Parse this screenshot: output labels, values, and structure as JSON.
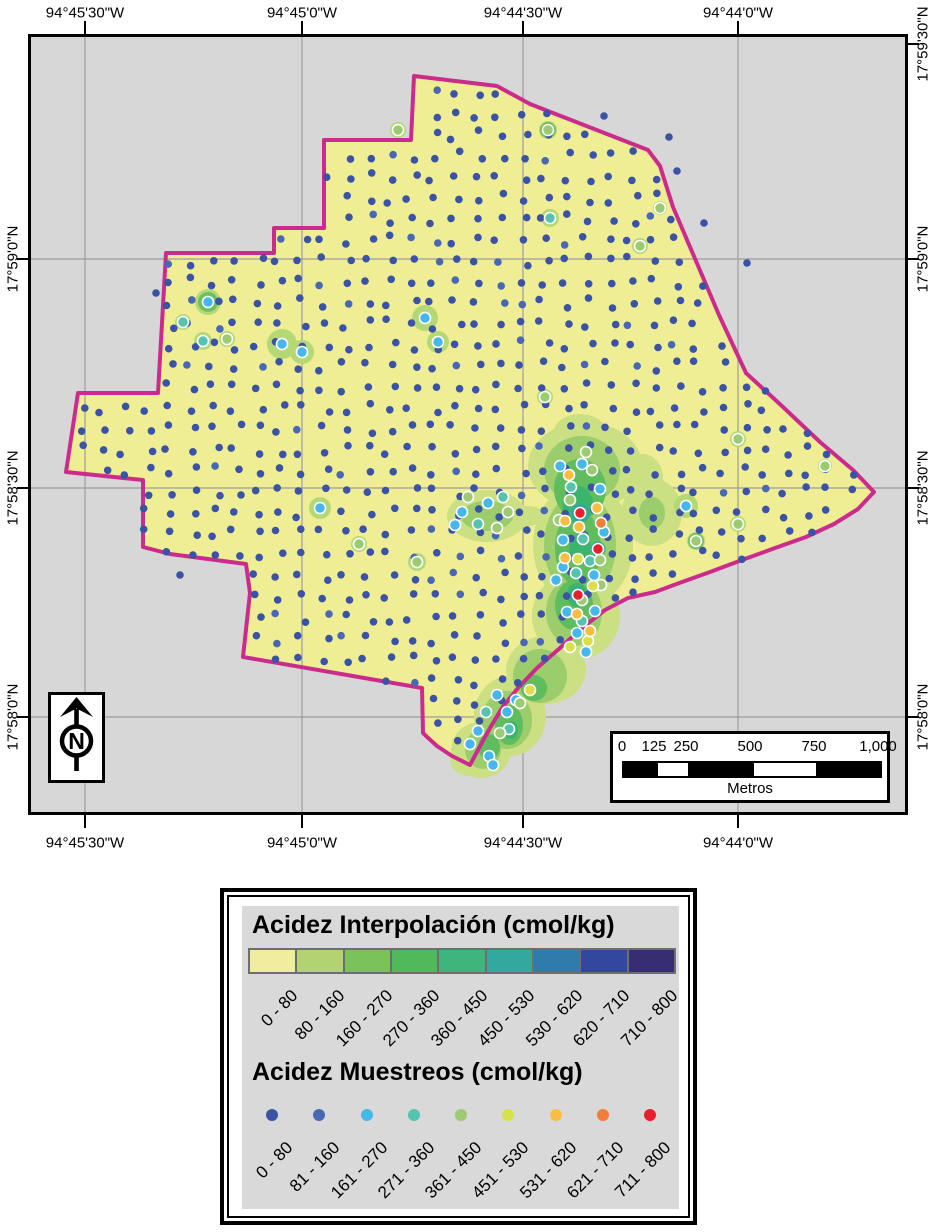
{
  "axes": {
    "top": [
      {
        "label": "94°45'30\"W",
        "x": 85
      },
      {
        "label": "94°45'0\"W",
        "x": 302
      },
      {
        "label": "94°44'30\"W",
        "x": 523
      },
      {
        "label": "94°44'0\"W",
        "x": 738
      }
    ],
    "bottom": [
      {
        "label": "94°45'30\"W",
        "x": 85
      },
      {
        "label": "94°45'0\"W",
        "x": 302
      },
      {
        "label": "94°44'30\"W",
        "x": 523
      },
      {
        "label": "94°44'0\"W",
        "x": 738
      }
    ],
    "left": [
      {
        "label": "17°59'0\"N",
        "y": 259
      },
      {
        "label": "17°58'30\"N",
        "y": 488
      },
      {
        "label": "17°58'0\"N",
        "y": 717
      }
    ],
    "right": [
      {
        "label": "17°59'30\"N",
        "y": 44
      },
      {
        "label": "17°59'0\"N",
        "y": 259
      },
      {
        "label": "17°58'30\"N",
        "y": 488
      },
      {
        "label": "17°58'0\"N",
        "y": 717
      }
    ]
  },
  "map": {
    "bg": "#d7d7d7",
    "grid_color": "#9c9c9c",
    "field_fill": "#f0ee95",
    "boundary_color": "#cb2c8c",
    "grid_v": [
      85,
      302,
      523,
      738
    ],
    "grid_h": [
      259,
      488,
      717
    ],
    "boundary": [
      [
        414,
        76
      ],
      [
        497,
        86
      ],
      [
        530,
        104
      ],
      [
        648,
        150
      ],
      [
        660,
        166
      ],
      [
        673,
        207
      ],
      [
        696,
        261
      ],
      [
        719,
        315
      ],
      [
        746,
        373
      ],
      [
        783,
        407
      ],
      [
        820,
        442
      ],
      [
        853,
        470
      ],
      [
        874,
        492
      ],
      [
        858,
        509
      ],
      [
        834,
        524
      ],
      [
        806,
        537
      ],
      [
        775,
        548
      ],
      [
        742,
        560
      ],
      [
        710,
        572
      ],
      [
        682,
        582
      ],
      [
        655,
        592
      ],
      [
        628,
        598
      ],
      [
        605,
        610
      ],
      [
        582,
        628
      ],
      [
        560,
        648
      ],
      [
        537,
        668
      ],
      [
        518,
        688
      ],
      [
        502,
        708
      ],
      [
        490,
        728
      ],
      [
        479,
        748
      ],
      [
        470,
        765
      ],
      [
        452,
        756
      ],
      [
        437,
        746
      ],
      [
        426,
        736
      ],
      [
        423,
        733
      ],
      [
        422,
        688
      ],
      [
        243,
        657
      ],
      [
        250,
        593
      ],
      [
        246,
        564
      ],
      [
        170,
        554
      ],
      [
        143,
        547
      ],
      [
        143,
        480
      ],
      [
        66,
        472
      ],
      [
        78,
        393
      ],
      [
        158,
        393
      ],
      [
        166,
        253
      ],
      [
        274,
        253
      ],
      [
        274,
        228
      ],
      [
        324,
        228
      ],
      [
        324,
        140
      ],
      [
        411,
        140
      ]
    ],
    "green_levels": [
      {
        "color": "#cbdf83",
        "ellipses": [
          [
            585,
            466,
            57,
            44
          ],
          [
            583,
            545,
            50,
            62
          ],
          [
            576,
            616,
            44,
            44
          ],
          [
            546,
            670,
            40,
            34
          ],
          [
            510,
            716,
            36,
            40
          ],
          [
            481,
            750,
            30,
            28
          ],
          [
            470,
            760,
            20,
            16
          ],
          [
            487,
            516,
            40,
            26
          ],
          [
            527,
            516,
            18,
            10
          ],
          [
            652,
            512,
            30,
            34
          ],
          [
            643,
            478,
            20,
            24
          ],
          [
            580,
            432,
            26,
            18
          ]
        ]
      },
      {
        "color": "#9bcd6c",
        "ellipses": [
          [
            582,
            470,
            38,
            34
          ],
          [
            580,
            545,
            36,
            52
          ],
          [
            574,
            612,
            28,
            34
          ],
          [
            540,
            676,
            27,
            27
          ],
          [
            507,
            720,
            25,
            29
          ],
          [
            483,
            749,
            18,
            20
          ],
          [
            487,
            516,
            26,
            15
          ],
          [
            652,
            513,
            13,
            16
          ]
        ]
      },
      {
        "color": "#5fbd5e",
        "ellipses": [
          [
            580,
            489,
            26,
            30
          ],
          [
            578,
            548,
            23,
            38
          ],
          [
            574,
            605,
            19,
            25
          ],
          [
            534,
            688,
            13,
            13
          ],
          [
            509,
            725,
            14,
            20
          ],
          [
            489,
            747,
            11,
            13
          ]
        ]
      },
      {
        "color": "#3cb46e",
        "ellipses": [
          [
            578,
            505,
            15,
            19
          ],
          [
            580,
            549,
            11,
            15
          ],
          [
            577,
            595,
            10,
            12
          ],
          [
            511,
            730,
            7,
            9
          ]
        ]
      },
      {
        "color": "#2fa9a0",
        "ellipses": [
          [
            580,
            513,
            9,
            9
          ],
          [
            598,
            549,
            7.5,
            7.5
          ],
          [
            578,
            595,
            7.5,
            7.5
          ]
        ]
      },
      {
        "color": "#2e74ae",
        "ellipses": [
          [
            580,
            513,
            6,
            6
          ]
        ]
      }
    ],
    "spots": [
      [
        208,
        302,
        13,
        2,
        7
      ],
      [
        183,
        322,
        8,
        3
      ],
      [
        203,
        341,
        9,
        3
      ],
      [
        227,
        339,
        8,
        4
      ],
      [
        282,
        344,
        15,
        2
      ],
      [
        302,
        352,
        12,
        2
      ],
      [
        425,
        318,
        13,
        2
      ],
      [
        438,
        342,
        11,
        2
      ],
      [
        548,
        130,
        9,
        4,
        5
      ],
      [
        550,
        218,
        9,
        3
      ],
      [
        640,
        246,
        8,
        4
      ],
      [
        398,
        130,
        8,
        4
      ],
      [
        320,
        508,
        11,
        2
      ],
      [
        359,
        544,
        8,
        4
      ],
      [
        417,
        562,
        9,
        4
      ],
      [
        738,
        439,
        8,
        4
      ],
      [
        738,
        524,
        8,
        4
      ],
      [
        696,
        541,
        9,
        4,
        5
      ],
      [
        686,
        506,
        12,
        2
      ],
      [
        825,
        466,
        7,
        4
      ],
      [
        660,
        208,
        7,
        4
      ],
      [
        545,
        397,
        8,
        4
      ]
    ],
    "special_dots": [
      [
        560,
        466,
        2
      ],
      [
        582,
        464,
        2
      ],
      [
        600,
        489,
        2
      ],
      [
        604,
        532,
        2
      ],
      [
        563,
        540,
        2
      ],
      [
        563,
        567,
        2
      ],
      [
        594,
        575,
        2
      ],
      [
        556,
        580,
        2
      ],
      [
        595,
        611,
        2
      ],
      [
        567,
        612,
        2
      ],
      [
        577,
        633,
        2
      ],
      [
        586,
        652,
        2
      ],
      [
        571,
        487,
        3
      ],
      [
        583,
        539,
        3
      ],
      [
        590,
        561,
        3
      ],
      [
        576,
        573,
        3
      ],
      [
        582,
        621,
        3
      ],
      [
        586,
        452,
        4
      ],
      [
        570,
        500,
        4
      ],
      [
        600,
        560,
        4
      ],
      [
        582,
        600,
        4
      ],
      [
        592,
        470,
        4
      ],
      [
        559,
        520,
        4
      ],
      [
        601,
        585,
        4
      ],
      [
        593,
        586,
        5
      ],
      [
        578,
        559,
        5
      ],
      [
        588,
        641,
        5
      ],
      [
        570,
        647,
        5
      ],
      [
        569,
        475,
        6
      ],
      [
        565,
        521,
        6
      ],
      [
        579,
        527,
        6
      ],
      [
        565,
        558,
        6
      ],
      [
        597,
        508,
        6
      ],
      [
        577,
        614,
        6
      ],
      [
        590,
        631,
        6
      ],
      [
        601,
        523,
        7
      ],
      [
        580,
        513,
        8
      ],
      [
        598,
        549,
        8
      ],
      [
        578,
        595,
        8
      ],
      [
        462,
        512,
        2
      ],
      [
        488,
        503,
        2
      ],
      [
        478,
        524,
        3
      ],
      [
        503,
        497,
        3
      ],
      [
        468,
        497,
        4
      ],
      [
        497,
        528,
        4
      ],
      [
        508,
        512,
        4
      ],
      [
        455,
        525,
        2
      ],
      [
        497,
        695,
        2
      ],
      [
        507,
        712,
        2
      ],
      [
        489,
        756,
        2
      ],
      [
        478,
        731,
        2
      ],
      [
        516,
        700,
        2
      ],
      [
        486,
        712,
        3
      ],
      [
        509,
        729,
        3
      ],
      [
        520,
        703,
        4
      ],
      [
        500,
        733,
        4
      ],
      [
        530,
        690,
        5
      ],
      [
        470,
        744,
        2
      ],
      [
        493,
        765,
        2
      ]
    ],
    "extra_blue_dots": [
      [
        604,
        116
      ],
      [
        669,
        137
      ],
      [
        677,
        171
      ],
      [
        704,
        223
      ],
      [
        747,
        263
      ],
      [
        156,
        293
      ],
      [
        180,
        575
      ]
    ],
    "blue_dots": {
      "x0": 38,
      "y0": 72,
      "dx": 22,
      "dy": 21,
      "jitter_x": 6,
      "jitter_y": 5,
      "seed": 12345,
      "r": 3.8,
      "alt_rate": 0.08
    }
  },
  "north_arrow": {
    "letter": "N"
  },
  "scalebar": {
    "labels": [
      "0",
      "125",
      "250",
      "500",
      "750",
      "1,000"
    ],
    "fractions": [
      0,
      0.125,
      0.25,
      0.5,
      0.75,
      1
    ],
    "segment_fracs": [
      0.125,
      0.125,
      0.25,
      0.25,
      0.25
    ],
    "segment_colors": [
      "#000000",
      "#ffffff",
      "#000000",
      "#ffffff",
      "#000000"
    ],
    "unit": "Metros"
  },
  "legend": {
    "interp": {
      "title": "Acidez Interpolación (cmol/kg)",
      "classes": [
        "0 - 80",
        "80 - 160",
        "160 - 270",
        "270 - 360",
        "360 - 450",
        "450 - 530",
        "530 - 620",
        "620 - 710",
        "710 - 800"
      ],
      "colors": [
        "#f0ee9c",
        "#b3d271",
        "#7cc25a",
        "#4fb95c",
        "#3db57d",
        "#33a89e",
        "#2e7bac",
        "#33479e",
        "#372d73"
      ]
    },
    "samples": {
      "title": "Acidez Muestreos (cmol/kg)",
      "classes": [
        "0 - 80",
        "81 - 160",
        "161 - 270",
        "271 - 360",
        "361 - 450",
        "451 - 530",
        "531 - 620",
        "621 - 710",
        "711 - 800"
      ],
      "colors": [
        "#3b53a4",
        "#4968b3",
        "#45b7eb",
        "#55c4ae",
        "#9ccb74",
        "#d9e04c",
        "#f9bd45",
        "#f07d3a",
        "#e81f2d"
      ]
    }
  }
}
